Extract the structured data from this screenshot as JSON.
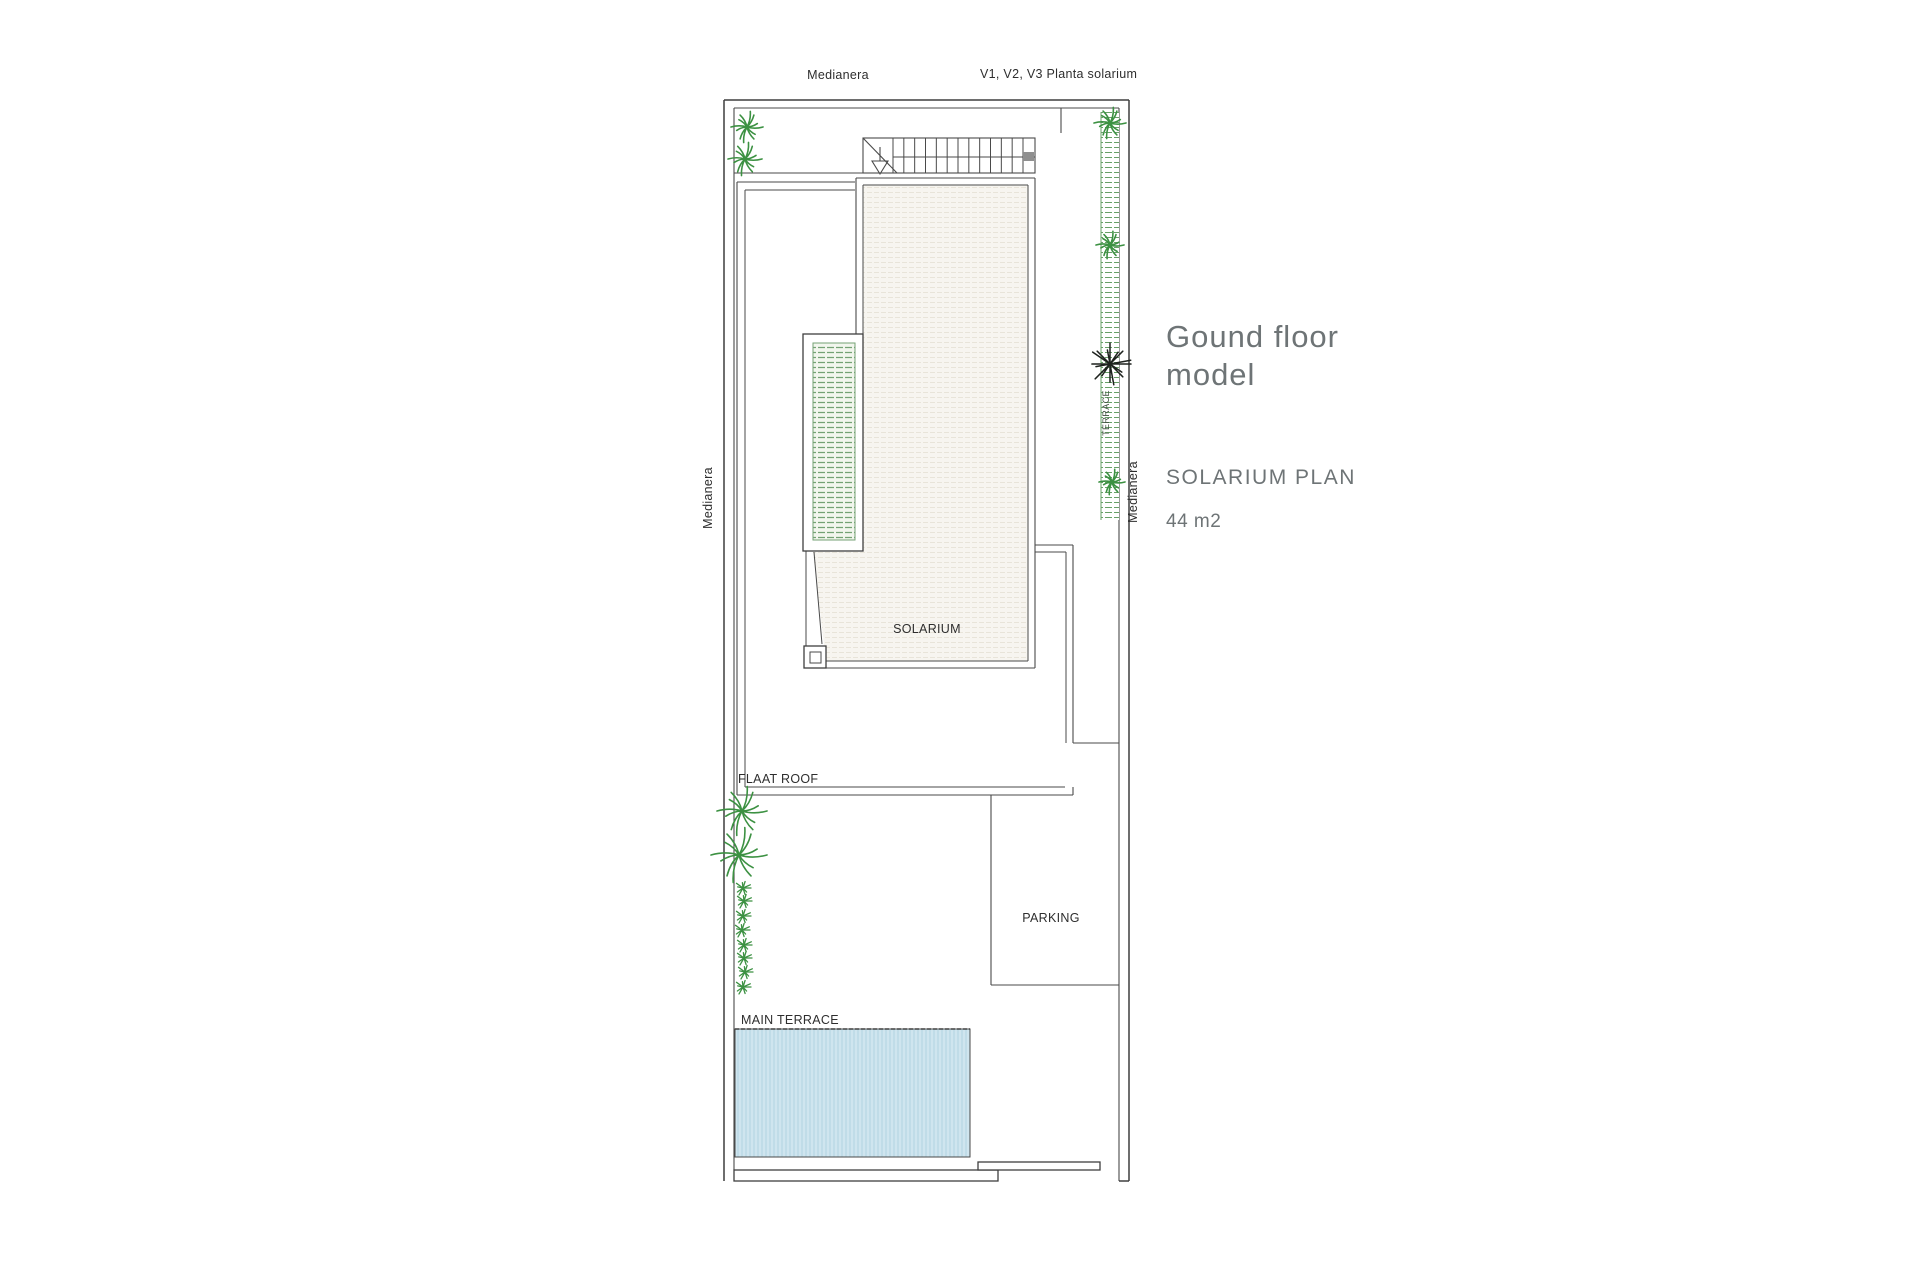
{
  "annotations": {
    "medianera_top": "Medianera",
    "v_windows": "V1, V2, V3 Planta solarium",
    "medianera_left": "Medianera",
    "medianera_right": "Medianera",
    "terrace_side": "TERRACE",
    "flat_roof": "FLAAT ROOF",
    "solarium": "SOLARIUM",
    "parking": "PARKING",
    "main_terrace": "MAIN TERRACE"
  },
  "info_panel": {
    "title_line1": "Gound floor",
    "title_line2": "model",
    "subtitle": "SOLARIUM PLAN",
    "area": "44 m2"
  },
  "colors": {
    "line": "#4a4a4a",
    "wall": "#3f3f3f",
    "floor_base": "#f7f5f0",
    "floor_line": "#e8e4d9",
    "planter_base": "#f2f6ee",
    "planter_line": "#74a274",
    "strip_line": "#67a067",
    "pool_base": "#cfe5ef",
    "pool_stripe": "#b7d7e3",
    "plant_green": "#3c9142",
    "plant_dark": "#1e221e",
    "text_dark": "#2e2e2e",
    "info_text": "#6e7476",
    "terrace_text": "#3f4f3f",
    "stair_gray": "#8f8f8f"
  },
  "plants": {
    "large": [
      {
        "x": 747,
        "y": 127,
        "r": 16
      },
      {
        "x": 745,
        "y": 159,
        "r": 17
      },
      {
        "x": 1110,
        "y": 123,
        "r": 16
      },
      {
        "x": 1110,
        "y": 245,
        "r": 14
      },
      {
        "x": 1112,
        "y": 482,
        "r": 13
      },
      {
        "x": 742,
        "y": 811,
        "r": 25
      },
      {
        "x": 739,
        "y": 855,
        "r": 28
      }
    ],
    "black": [
      {
        "x": 1110,
        "y": 364,
        "r": 21
      }
    ],
    "small": [
      {
        "x": 743,
        "y": 888,
        "r": 8
      },
      {
        "x": 744,
        "y": 901,
        "r": 8
      },
      {
        "x": 743,
        "y": 916,
        "r": 8
      },
      {
        "x": 742,
        "y": 930,
        "r": 8
      },
      {
        "x": 744,
        "y": 945,
        "r": 8
      },
      {
        "x": 744,
        "y": 958,
        "r": 8
      },
      {
        "x": 745,
        "y": 972,
        "r": 8
      },
      {
        "x": 743,
        "y": 987,
        "r": 8
      }
    ]
  },
  "stairs": {
    "tread_count": 13,
    "x_start": 893,
    "x_end": 1023,
    "y_top": 138,
    "y_bottom": 173
  }
}
